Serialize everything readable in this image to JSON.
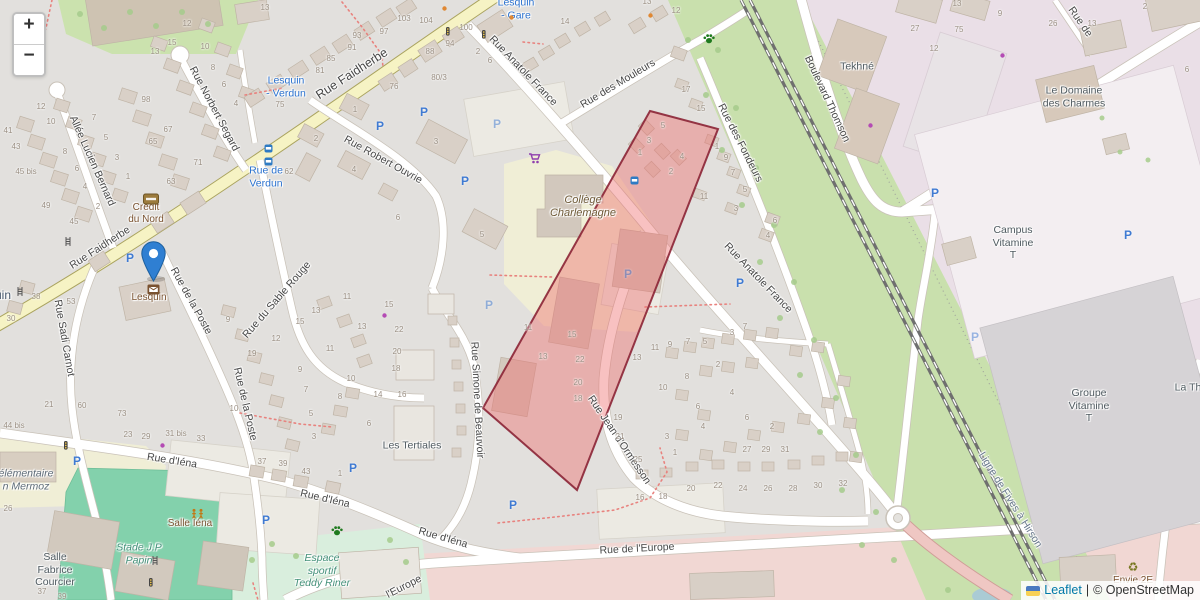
{
  "zoom_control": {
    "zoom_in": "+",
    "zoom_out": "−"
  },
  "attribution": {
    "leaflet_link": "Leaflet",
    "separator": "|",
    "osm_text": "© OpenStreetMap",
    "flag": "ukraine-flag"
  },
  "colors": {
    "highlight_fill": "#ee6c6c",
    "highlight_border": "#8b2435",
    "marker_blue": "#2f7fd2",
    "link_blue": "#0078a8",
    "transit_label_blue": "#2b72cf",
    "road_yellow": "#f6f3c4",
    "pitch_teal": "#83d1ac",
    "grass_green": "#c9e0ad",
    "industrial_lavender": "#eadfe7",
    "apron_pink": "#f1d7d3"
  },
  "map": {
    "street_labels": [
      {
        "text": "Rue Faidherbe",
        "x": 352,
        "y": 74,
        "r": -33,
        "cls": "big"
      },
      {
        "text": "Rue Faidherbe",
        "x": 100,
        "y": 248,
        "r": -33
      },
      {
        "text": "Rue Anatole France",
        "x": 523,
        "y": 71,
        "r": 46
      },
      {
        "text": "Rue Anatole France",
        "x": 758,
        "y": 278,
        "r": 46
      },
      {
        "text": "Rue des Mouleurs",
        "x": 618,
        "y": 84,
        "r": -31
      },
      {
        "text": "Rue des Fondeurs",
        "x": 740,
        "y": 143,
        "r": 63
      },
      {
        "text": "Boulevard Thomson",
        "x": 827,
        "y": 99,
        "r": 65
      },
      {
        "text": "Rue Norbert Segard",
        "x": 214,
        "y": 109,
        "r": 62
      },
      {
        "text": "Allée Lucien Bernard",
        "x": 92,
        "y": 161,
        "r": 66
      },
      {
        "text": "Rue Robert Ouvrie",
        "x": 383,
        "y": 160,
        "r": 29
      },
      {
        "text": "Rue du Sable Rouge",
        "x": 277,
        "y": 300,
        "r": -49
      },
      {
        "text": "Rue Sadi Carnot",
        "x": 64,
        "y": 338,
        "r": 80
      },
      {
        "text": "Rue de la Poste",
        "x": 191,
        "y": 301,
        "r": 61
      },
      {
        "text": "Rue de la Poste",
        "x": 245,
        "y": 404,
        "r": 77
      },
      {
        "text": "Rue d'Iéna",
        "x": 172,
        "y": 461,
        "r": 9
      },
      {
        "text": "Rue d'Iéna",
        "x": 325,
        "y": 499,
        "r": 13
      },
      {
        "text": "Rue d'Iéna",
        "x": 443,
        "y": 538,
        "r": 16
      },
      {
        "text": "Rue de l'Europe",
        "x": 637,
        "y": 549,
        "r": -3
      },
      {
        "text": "l'Europe",
        "x": 404,
        "y": 587,
        "r": -27
      },
      {
        "text": "Rue Simone de Beauvoir",
        "x": 477,
        "y": 400,
        "r": 87
      },
      {
        "text": "Rue Jean d'Ormesson",
        "x": 619,
        "y": 440,
        "r": 56
      },
      {
        "text": "Ligne de Fives à Hirson",
        "x": 1010,
        "y": 500,
        "r": 58,
        "cls": "rail"
      },
      {
        "text": "Rue de",
        "x": 1080,
        "y": 22,
        "r": 55
      }
    ],
    "place_labels": [
      {
        "text": "Collège\nCharlemagne",
        "x": 583,
        "y": 207,
        "cls": "school"
      },
      {
        "text": "élémentaire\nn Mermoz",
        "x": 26,
        "y": 480,
        "cls": "edu"
      },
      {
        "text": "Crédit\ndu Nord",
        "x": 146,
        "y": 214,
        "cls": "amenity"
      },
      {
        "text": "Lesquin",
        "x": 149,
        "y": 298,
        "cls": "amenity"
      },
      {
        "text": "Salle Iéna",
        "x": 190,
        "y": 524,
        "cls": "amenity"
      },
      {
        "text": "Envie 2E",
        "x": 1133,
        "y": 581,
        "cls": "amenity"
      },
      {
        "text": "Les Tertiales",
        "x": 412,
        "y": 446,
        "cls": "gray"
      },
      {
        "text": "Salle\nFabrice\nCourcier",
        "x": 55,
        "y": 570,
        "cls": "gray"
      },
      {
        "text": "Tekhné",
        "x": 857,
        "y": 67,
        "cls": "gray"
      },
      {
        "text": "Le Domaine\ndes Charmes",
        "x": 1074,
        "y": 97,
        "cls": "gray"
      },
      {
        "text": "Campus\nVitamine\nT",
        "x": 1013,
        "y": 243,
        "cls": "gray"
      },
      {
        "text": "Groupe\nVitamine\nT",
        "x": 1089,
        "y": 406,
        "cls": "gray"
      },
      {
        "text": "La Th",
        "x": 1188,
        "y": 388,
        "cls": "gray"
      },
      {
        "text": "Stade J.P\nPapin",
        "x": 139,
        "y": 554,
        "cls": "leisure"
      },
      {
        "text": "Espace\nsportif\nTeddy Riner",
        "x": 322,
        "y": 571,
        "cls": "leisure"
      },
      {
        "text": "Lesquin\n- Gare",
        "x": 516,
        "y": 9,
        "cls": "transit"
      },
      {
        "text": "Lesquin\n- Verdun",
        "x": 286,
        "y": 87,
        "cls": "transit"
      },
      {
        "text": "Rue de\nVerdun",
        "x": 266,
        "y": 177,
        "cls": "transit"
      },
      {
        "text": "Lesquin",
        "x": -10,
        "y": 295,
        "cls": "city"
      }
    ],
    "house_numbers": [
      {
        "t": "12",
        "x": 41,
        "y": 107
      },
      {
        "t": "10",
        "x": 51,
        "y": 122
      },
      {
        "t": "8",
        "x": 65,
        "y": 152
      },
      {
        "t": "6",
        "x": 77,
        "y": 169
      },
      {
        "t": "4",
        "x": 85,
        "y": 187
      },
      {
        "t": "2",
        "x": 98,
        "y": 207
      },
      {
        "t": "41",
        "x": 8,
        "y": 131
      },
      {
        "t": "43",
        "x": 16,
        "y": 147
      },
      {
        "t": "45 bis",
        "x": 26,
        "y": 172
      },
      {
        "t": "49",
        "x": 46,
        "y": 206
      },
      {
        "t": "45",
        "x": 74,
        "y": 222
      },
      {
        "t": "7",
        "x": 94,
        "y": 118
      },
      {
        "t": "5",
        "x": 106,
        "y": 138
      },
      {
        "t": "3",
        "x": 117,
        "y": 158
      },
      {
        "t": "1",
        "x": 128,
        "y": 177
      },
      {
        "t": "98",
        "x": 146,
        "y": 100
      },
      {
        "t": "67",
        "x": 168,
        "y": 130
      },
      {
        "t": "65",
        "x": 153,
        "y": 142
      },
      {
        "t": "63",
        "x": 171,
        "y": 182
      },
      {
        "t": "71",
        "x": 198,
        "y": 163
      },
      {
        "t": "12",
        "x": 187,
        "y": 24
      },
      {
        "t": "15",
        "x": 172,
        "y": 43
      },
      {
        "t": "13",
        "x": 155,
        "y": 52
      },
      {
        "t": "10",
        "x": 205,
        "y": 47
      },
      {
        "t": "8",
        "x": 213,
        "y": 68
      },
      {
        "t": "6",
        "x": 224,
        "y": 85
      },
      {
        "t": "4",
        "x": 236,
        "y": 104
      },
      {
        "t": "75",
        "x": 280,
        "y": 105
      },
      {
        "t": "62",
        "x": 289,
        "y": 172
      },
      {
        "t": "13",
        "x": 265,
        "y": 8
      },
      {
        "t": "93",
        "x": 357,
        "y": 36
      },
      {
        "t": "91",
        "x": 352,
        "y": 48
      },
      {
        "t": "85",
        "x": 331,
        "y": 59
      },
      {
        "t": "81",
        "x": 320,
        "y": 71
      },
      {
        "t": "97",
        "x": 384,
        "y": 32
      },
      {
        "t": "103",
        "x": 404,
        "y": 19
      },
      {
        "t": "104",
        "x": 426,
        "y": 21
      },
      {
        "t": "100",
        "x": 466,
        "y": 28
      },
      {
        "t": "94",
        "x": 450,
        "y": 44
      },
      {
        "t": "88",
        "x": 430,
        "y": 52
      },
      {
        "t": "80/3",
        "x": 439,
        "y": 78
      },
      {
        "t": "76",
        "x": 394,
        "y": 87
      },
      {
        "t": "2",
        "x": 478,
        "y": 52
      },
      {
        "t": "6",
        "x": 490,
        "y": 61
      },
      {
        "t": "14",
        "x": 565,
        "y": 22
      },
      {
        "t": "12",
        "x": 676,
        "y": 11
      },
      {
        "t": "13",
        "x": 647,
        "y": 2
      },
      {
        "t": "27",
        "x": 915,
        "y": 29
      },
      {
        "t": "12",
        "x": 934,
        "y": 49
      },
      {
        "t": "75",
        "x": 959,
        "y": 30
      },
      {
        "t": "13",
        "x": 957,
        "y": 4
      },
      {
        "t": "9",
        "x": 1000,
        "y": 14
      },
      {
        "t": "26",
        "x": 1053,
        "y": 24
      },
      {
        "t": "13",
        "x": 1092,
        "y": 24
      },
      {
        "t": "2",
        "x": 1145,
        "y": 7
      },
      {
        "t": "6",
        "x": 1187,
        "y": 70
      },
      {
        "t": "17",
        "x": 686,
        "y": 90
      },
      {
        "t": "15",
        "x": 701,
        "y": 109
      },
      {
        "t": "7",
        "x": 733,
        "y": 173
      },
      {
        "t": "5",
        "x": 745,
        "y": 190
      },
      {
        "t": "5",
        "x": 663,
        "y": 126
      },
      {
        "t": "3",
        "x": 649,
        "y": 141
      },
      {
        "t": "1",
        "x": 640,
        "y": 153
      },
      {
        "t": "4",
        "x": 682,
        "y": 157
      },
      {
        "t": "2",
        "x": 671,
        "y": 172
      },
      {
        "t": "1",
        "x": 717,
        "y": 147
      },
      {
        "t": "9",
        "x": 726,
        "y": 158
      },
      {
        "t": "3",
        "x": 736,
        "y": 209
      },
      {
        "t": "11",
        "x": 704,
        "y": 197
      },
      {
        "t": "6",
        "x": 775,
        "y": 221
      },
      {
        "t": "4",
        "x": 768,
        "y": 236
      },
      {
        "t": "15",
        "x": 572,
        "y": 335
      },
      {
        "t": "11",
        "x": 528,
        "y": 328
      },
      {
        "t": "13",
        "x": 543,
        "y": 357
      },
      {
        "t": "22",
        "x": 580,
        "y": 360
      },
      {
        "t": "20",
        "x": 578,
        "y": 383
      },
      {
        "t": "18",
        "x": 578,
        "y": 399
      },
      {
        "t": "13",
        "x": 637,
        "y": 358
      },
      {
        "t": "19",
        "x": 618,
        "y": 418
      },
      {
        "t": "21",
        "x": 620,
        "y": 437
      },
      {
        "t": "25",
        "x": 638,
        "y": 460
      },
      {
        "t": "3",
        "x": 667,
        "y": 437
      },
      {
        "t": "1",
        "x": 675,
        "y": 453
      },
      {
        "t": "6",
        "x": 698,
        "y": 407
      },
      {
        "t": "4",
        "x": 703,
        "y": 427
      },
      {
        "t": "4",
        "x": 732,
        "y": 393
      },
      {
        "t": "6",
        "x": 747,
        "y": 418
      },
      {
        "t": "2",
        "x": 772,
        "y": 427
      },
      {
        "t": "7",
        "x": 745,
        "y": 327
      },
      {
        "t": "3",
        "x": 732,
        "y": 333
      },
      {
        "t": "5",
        "x": 705,
        "y": 342
      },
      {
        "t": "7",
        "x": 688,
        "y": 342
      },
      {
        "t": "9",
        "x": 670,
        "y": 345
      },
      {
        "t": "11",
        "x": 655,
        "y": 348
      },
      {
        "t": "10",
        "x": 663,
        "y": 388
      },
      {
        "t": "8",
        "x": 687,
        "y": 377
      },
      {
        "t": "2",
        "x": 718,
        "y": 365
      },
      {
        "t": "27",
        "x": 747,
        "y": 450
      },
      {
        "t": "29",
        "x": 766,
        "y": 450
      },
      {
        "t": "31",
        "x": 785,
        "y": 450
      },
      {
        "t": "16",
        "x": 640,
        "y": 498
      },
      {
        "t": "18",
        "x": 663,
        "y": 497
      },
      {
        "t": "20",
        "x": 691,
        "y": 489
      },
      {
        "t": "22",
        "x": 718,
        "y": 486
      },
      {
        "t": "24",
        "x": 743,
        "y": 489
      },
      {
        "t": "26",
        "x": 768,
        "y": 489
      },
      {
        "t": "28",
        "x": 793,
        "y": 489
      },
      {
        "t": "30",
        "x": 818,
        "y": 486
      },
      {
        "t": "32",
        "x": 843,
        "y": 484
      },
      {
        "t": "21",
        "x": 49,
        "y": 405
      },
      {
        "t": "60",
        "x": 82,
        "y": 406
      },
      {
        "t": "73",
        "x": 122,
        "y": 414
      },
      {
        "t": "23",
        "x": 128,
        "y": 435
      },
      {
        "t": "29",
        "x": 146,
        "y": 437
      },
      {
        "t": "31 bis",
        "x": 176,
        "y": 434
      },
      {
        "t": "33",
        "x": 201,
        "y": 439
      },
      {
        "t": "10",
        "x": 234,
        "y": 409
      },
      {
        "t": "26",
        "x": 8,
        "y": 509
      },
      {
        "t": "37",
        "x": 42,
        "y": 592
      },
      {
        "t": "39",
        "x": 62,
        "y": 597
      },
      {
        "t": "37",
        "x": 262,
        "y": 462
      },
      {
        "t": "39",
        "x": 283,
        "y": 464
      },
      {
        "t": "43",
        "x": 306,
        "y": 472
      },
      {
        "t": "1",
        "x": 340,
        "y": 474
      },
      {
        "t": "53",
        "x": 71,
        "y": 302
      },
      {
        "t": "38",
        "x": 36,
        "y": 297
      },
      {
        "t": "30",
        "x": 11,
        "y": 319
      },
      {
        "t": "44 bis",
        "x": 14,
        "y": 426
      },
      {
        "t": "9",
        "x": 228,
        "y": 320
      },
      {
        "t": "19",
        "x": 252,
        "y": 354
      },
      {
        "t": "12",
        "x": 276,
        "y": 339
      },
      {
        "t": "15",
        "x": 300,
        "y": 322
      },
      {
        "t": "13",
        "x": 316,
        "y": 311
      },
      {
        "t": "11",
        "x": 330,
        "y": 349
      },
      {
        "t": "9",
        "x": 300,
        "y": 370
      },
      {
        "t": "7",
        "x": 306,
        "y": 390
      },
      {
        "t": "5",
        "x": 311,
        "y": 414
      },
      {
        "t": "3",
        "x": 314,
        "y": 437
      },
      {
        "t": "10",
        "x": 351,
        "y": 379
      },
      {
        "t": "8",
        "x": 340,
        "y": 397
      },
      {
        "t": "15",
        "x": 389,
        "y": 305
      },
      {
        "t": "13",
        "x": 362,
        "y": 327
      },
      {
        "t": "22",
        "x": 399,
        "y": 330
      },
      {
        "t": "20",
        "x": 397,
        "y": 352
      },
      {
        "t": "18",
        "x": 396,
        "y": 369
      },
      {
        "t": "14",
        "x": 378,
        "y": 395
      },
      {
        "t": "16",
        "x": 402,
        "y": 395
      },
      {
        "t": "6",
        "x": 369,
        "y": 424
      },
      {
        "t": "11",
        "x": 347,
        "y": 297
      },
      {
        "t": "1",
        "x": 355,
        "y": 110
      },
      {
        "t": "2",
        "x": 316,
        "y": 139
      },
      {
        "t": "4",
        "x": 354,
        "y": 170
      },
      {
        "t": "3",
        "x": 436,
        "y": 142
      },
      {
        "t": "6",
        "x": 398,
        "y": 218
      },
      {
        "t": "5",
        "x": 482,
        "y": 235
      }
    ],
    "icons": [
      {
        "kind": "parking",
        "x": 130,
        "y": 258
      },
      {
        "kind": "parking",
        "x": 380,
        "y": 126
      },
      {
        "kind": "parking",
        "x": 424,
        "y": 112
      },
      {
        "kind": "parking",
        "x": 465,
        "y": 181
      },
      {
        "kind": "parking",
        "x": 497,
        "y": 124,
        "faded": true
      },
      {
        "kind": "parking",
        "x": 628,
        "y": 274,
        "faded": true
      },
      {
        "kind": "parking",
        "x": 740,
        "y": 283
      },
      {
        "kind": "parking",
        "x": 489,
        "y": 305,
        "faded": true
      },
      {
        "kind": "parking",
        "x": 353,
        "y": 468
      },
      {
        "kind": "parking",
        "x": 513,
        "y": 505
      },
      {
        "kind": "parking",
        "x": 266,
        "y": 520
      },
      {
        "kind": "parking",
        "x": 77,
        "y": 461
      },
      {
        "kind": "parking",
        "x": 935,
        "y": 193
      },
      {
        "kind": "parking",
        "x": 1128,
        "y": 235
      },
      {
        "kind": "parking",
        "x": 975,
        "y": 337,
        "faded": true
      },
      {
        "kind": "bus-stop",
        "x": 264,
        "y": 144
      },
      {
        "kind": "bus-stop",
        "x": 264,
        "y": 157
      },
      {
        "kind": "bus-stop",
        "x": 630,
        "y": 176
      },
      {
        "kind": "paw",
        "x": 703,
        "y": 33
      },
      {
        "kind": "paw",
        "x": 331,
        "y": 525
      },
      {
        "kind": "shopping-cart",
        "x": 528,
        "y": 152
      },
      {
        "kind": "bank",
        "x": 143,
        "y": 193
      },
      {
        "kind": "post-envelope",
        "x": 147,
        "y": 284
      },
      {
        "kind": "playground",
        "x": 190,
        "y": 508
      },
      {
        "kind": "recycling",
        "x": 1133,
        "y": 567
      },
      {
        "kind": "poi-dot-orange",
        "x": 509,
        "y": 15
      },
      {
        "kind": "poi-dot-orange",
        "x": 648,
        "y": 13
      },
      {
        "kind": "poi-dot-orange",
        "x": 442,
        "y": 6
      },
      {
        "kind": "poi-dot-magenta",
        "x": 868,
        "y": 123
      },
      {
        "kind": "poi-dot-magenta",
        "x": 1000,
        "y": 53
      },
      {
        "kind": "poi-dot-magenta",
        "x": 160,
        "y": 443
      },
      {
        "kind": "poi-dot-magenta",
        "x": 382,
        "y": 313
      },
      {
        "kind": "traffic-signal",
        "x": 446,
        "y": 27
      },
      {
        "kind": "traffic-signal",
        "x": 482,
        "y": 30
      },
      {
        "kind": "traffic-signal",
        "x": 64,
        "y": 441
      },
      {
        "kind": "traffic-signal",
        "x": 149,
        "y": 578
      },
      {
        "kind": "crossing",
        "x": 65,
        "y": 237
      },
      {
        "kind": "crossing",
        "x": 17,
        "y": 287
      },
      {
        "kind": "crossing",
        "x": 152,
        "y": 556
      }
    ]
  }
}
